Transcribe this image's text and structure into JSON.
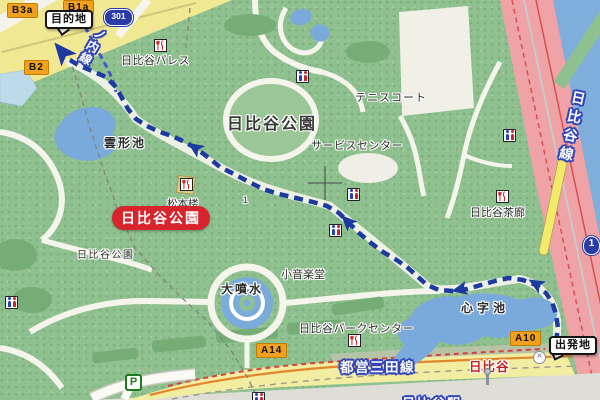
{
  "callouts": {
    "destination": "目的地",
    "departure": "出発地"
  },
  "exits": {
    "b3a": "B3a",
    "b1a": "B1a",
    "b2": "B2",
    "a14": "A14",
    "a10": "A10"
  },
  "road_shields": {
    "route_301": "301",
    "route_1": "1"
  },
  "rail_lines": {
    "marunouchi_partial": "ノ内線",
    "hibiya_line": "日比谷線",
    "toei_mita_line": "都営三田線",
    "hibiya_station": "日比谷",
    "hibiya_station_clipped": "日比谷駅"
  },
  "places": {
    "park_title": "日比谷公園",
    "park_badge": "日比谷公園",
    "park_name_small": "日比谷公園",
    "tennis_court": "テニスコート",
    "service_center": "サービスセンター",
    "hibiya_palace": "日比谷パレス",
    "matsumotoro": "松本楼",
    "hibiya_saro": "日比谷茶廊",
    "hibiya_park_center": "日比谷パークセンター",
    "small_music_hall": "小音楽堂",
    "great_fountain": "大噴水",
    "kumogata_pond": "雲形池",
    "shinji_pond": "心字池",
    "block_number": "1",
    "parking": "P"
  },
  "icons": {
    "restroom": "restroom-icon",
    "restaurant": "restaurant-icon",
    "parking": "parking-icon",
    "station_exit": "x-circle-icon",
    "streetlight": "streetlight-icon",
    "destination_arrow": "route-arrow"
  },
  "colors": {
    "park_green": "#8FC08F",
    "water_blue": "#7FAEDC",
    "pond_blue": "#79AADB",
    "road_pink": "#EFA3A6",
    "road_yellow": "#F2EDA0",
    "route_navy": "#1C3AA0",
    "exit_badge_orange": "#F2A11D",
    "poi_badge_red": "#D8242C",
    "rail_text_blue": "#3347B8",
    "mita_line_red": "#D64040"
  }
}
